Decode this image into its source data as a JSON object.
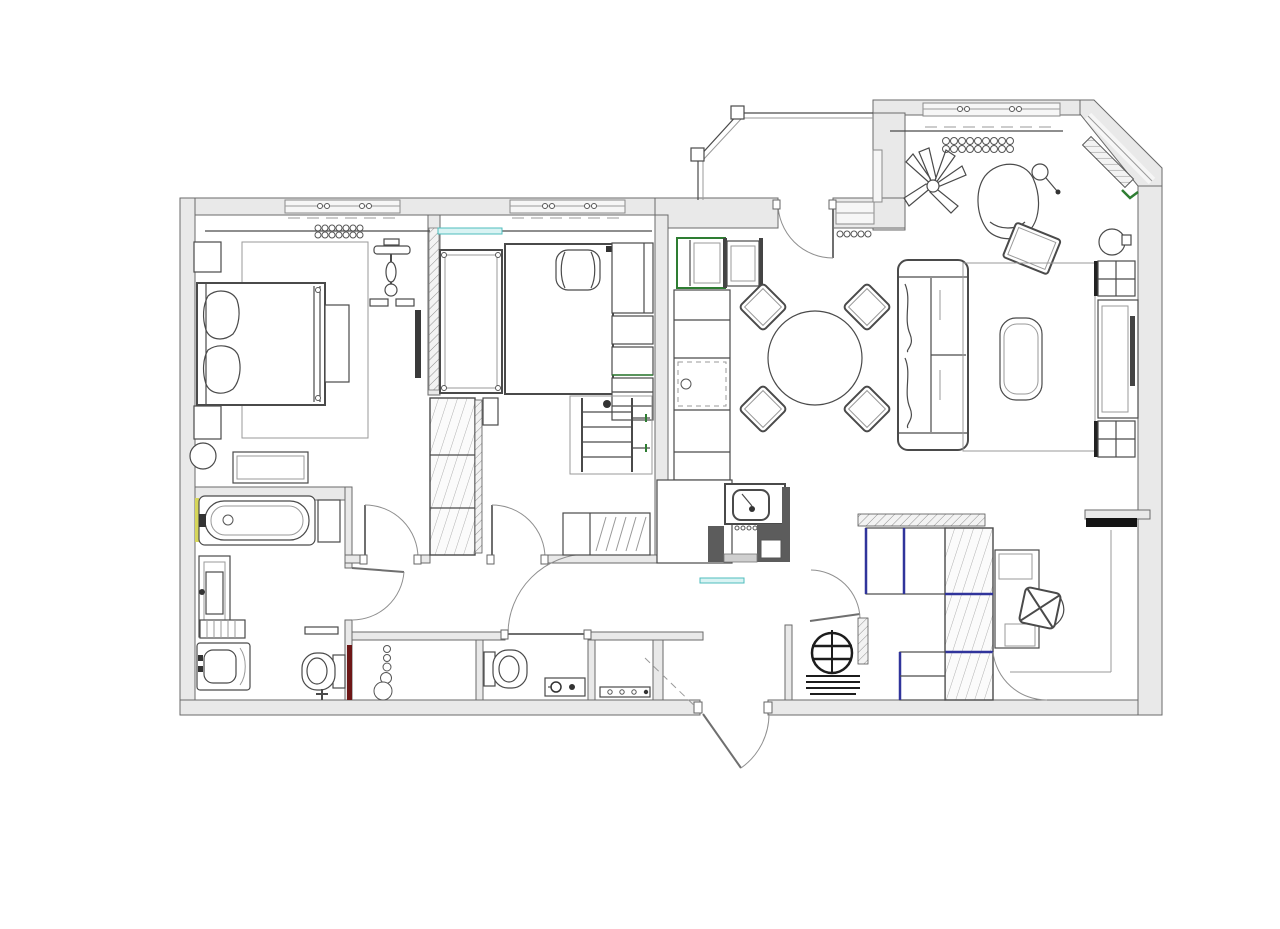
{
  "document": {
    "type": "architectural-floor-plan",
    "view": "top-down",
    "background": "#ffffff",
    "text_labels": []
  },
  "palette": {
    "wall_fill": "#e9e9e9",
    "wall_stroke": "#6a6a6a",
    "line": "#4a4a4a",
    "window_fill": "#f6f6f6",
    "counter_dark": "#5c5c5c",
    "tv_black": "#141414",
    "accent_green": "#2e7d32",
    "accent_navy": "#30349b",
    "accent_teal": "#4fbdbd",
    "accent_teal_fill": "#d9f3f3",
    "accent_maroon": "#6d1616",
    "accent_yellow": "#d6d65a",
    "hatch_line": "#8f8f8f",
    "hatch_soft": "#b0b0b0"
  },
  "plan": {
    "rooms": [
      {
        "name": "bedroom-1",
        "position": "top-left",
        "furniture": [
          "double-bed",
          "two-pillows",
          "bedside-table-top",
          "bedside-table-bottom",
          "foot-bench",
          "rug",
          "dresser",
          "round-pouf",
          "wall-mirror",
          "exercise-bike",
          "radiator-coil",
          "curtain-rail"
        ]
      },
      {
        "name": "bedroom-2",
        "position": "top-middle",
        "furniture": [
          "single-bed",
          "double-bed-with-pillow",
          "hatched-wardrobe",
          "wall-shelving-column",
          "clothes-rack",
          "striped-storage-bench",
          "side-cabinet",
          "radiator-coil",
          "curtain-rail"
        ]
      },
      {
        "name": "kitchen-dining-living",
        "position": "right",
        "furniture": [
          "fridge",
          "built-in-oven",
          "tall-cabinet-column",
          "sink-counter",
          "round-dining-table",
          "dining-chairs-x4",
          "sofa",
          "living-rug",
          "coffee-table",
          "armchair",
          "ottoman",
          "floor-lamp",
          "potted-plant",
          "side-table",
          "tv-wall-unit",
          "radiator-coil",
          "chamfer-radiator"
        ]
      },
      {
        "name": "balcony",
        "position": "top-center",
        "furniture": [
          "glazed-enclosure"
        ]
      },
      {
        "name": "bathroom",
        "position": "bottom-left",
        "furniture": [
          "bathtub",
          "tub-cabinet",
          "vanity-sink",
          "towel-radiator",
          "washing-machine",
          "wall-hung-toilet",
          "wall-shelf"
        ]
      },
      {
        "name": "wc",
        "position": "bottom-center",
        "furniture": [
          "wall-hung-toilet",
          "counter-sink",
          "basket-stack",
          "shelf-rack"
        ]
      },
      {
        "name": "hallway",
        "position": "center",
        "furniture": []
      },
      {
        "name": "entry-hall",
        "position": "bottom-right",
        "furniture": [
          "hatched-entry-wardrobe",
          "boiler-closet",
          "hatched-post",
          "desk",
          "desk-chair",
          "wall-mounted-tv"
        ]
      }
    ],
    "doors": [
      "vestibule-door",
      "bedroom-2-door",
      "bathroom-door",
      "wc-door",
      "closet-door",
      "balcony-door",
      "entry-double-door"
    ],
    "windows": [
      "bedroom-1-window",
      "bedroom-2-window",
      "living-room-window",
      "chamfer-window",
      "balcony-wall-window",
      "balcony-glazing"
    ]
  }
}
